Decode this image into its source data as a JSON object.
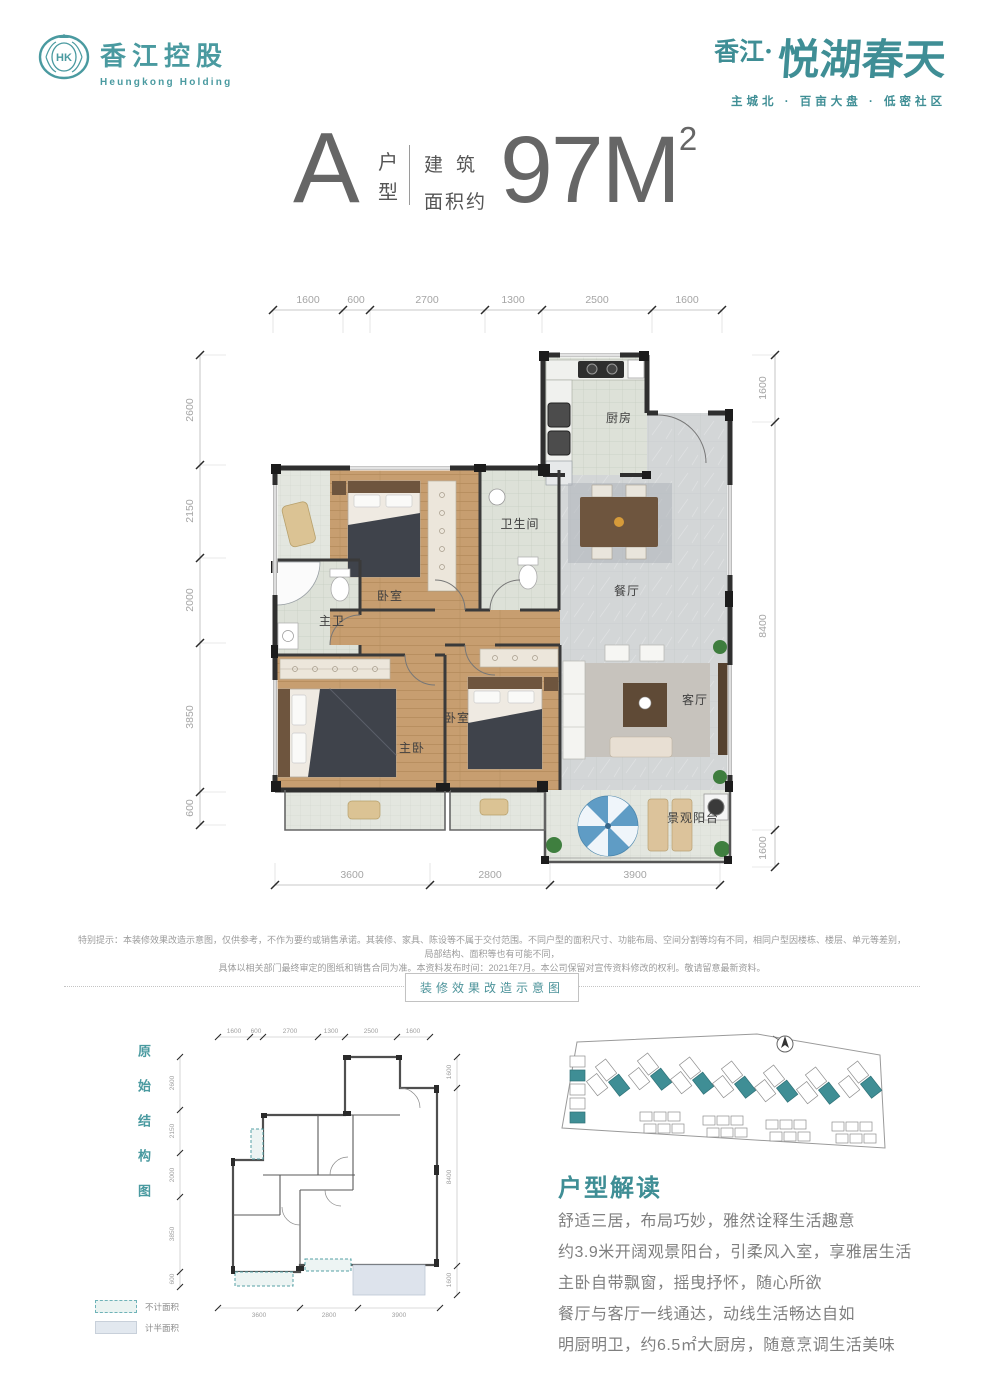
{
  "colors": {
    "brand_teal": "#3F8E95",
    "logo_teal": "#4A9AA0",
    "title_gray": "#666666",
    "wall_dark": "#2F2F2F",
    "dim_text": "#A5A5A5",
    "body_text": "#7F7F7F"
  },
  "header": {
    "logo": {
      "emblem_text": "HK",
      "name_cn": "香江控股",
      "name_en": "Heungkong Holding"
    },
    "brand": {
      "prefix": "香江·",
      "name": "悦湖春天",
      "tagline": "主城北 · 百亩大盘 · 低密社区"
    }
  },
  "title": {
    "unit_letter": "A",
    "unit_label_top": "户",
    "unit_label_bottom": "型",
    "area_prefix_line1": "建筑",
    "area_prefix_line2": "面积约",
    "area_value": "97M",
    "area_exponent": "2"
  },
  "floor_plan": {
    "dims_top": [
      "1600",
      "600",
      "2700",
      "1300",
      "2500",
      "1600"
    ],
    "dims_left": [
      "2600",
      "2150",
      "2000",
      "3850",
      "600"
    ],
    "dims_right": [
      "1600",
      "8400",
      "1600"
    ],
    "dims_bottom": [
      "3600",
      "2800",
      "3900"
    ],
    "rooms": {
      "kitchen": "厨房",
      "bathroom": "卫生间",
      "dining": "餐厅",
      "bedroom_top": "卧室",
      "master_bath": "主卫",
      "master_bedroom": "主卧",
      "bedroom_mid": "卧室",
      "living": "客厅",
      "balcony": "景观阳台"
    }
  },
  "disclaimer": {
    "line1": "特别提示：本装修效果改造示意图，仅供参考，不作为要约或销售承诺。其装修、家具、陈设等不属于交付范围。不同户型的面积尺寸、功能布局、空间分割等均有不同，相同户型因楼栋、楼层、单元等差别，局部结构、面积等也有可能不同，",
    "line2": "具体以相关部门最终审定的图纸和销售合同为准。本资料发布时间：2021年7月。本公司保留对宣传资料修改的权利。敬请留意最新资料。"
  },
  "divider": {
    "label": "装修效果改造示意图"
  },
  "original_plan": {
    "vertical_label": "原始结构图",
    "legend": {
      "no_area": "不计面积",
      "half_area": "计半面积"
    }
  },
  "analysis": {
    "heading": "户型解读",
    "lines": [
      "舒适三居，布局巧妙，雅然诠释生活趣意",
      "约3.9米开阔观景阳台，引柔风入室，享雅居生活",
      "主卧自带飘窗，摇曳抒怀，随心所欲",
      "餐厅与客厅一线通达，动线生活畅达自如",
      "明厨明卫，约6.5㎡大厨房，随意烹调生活美味"
    ]
  }
}
